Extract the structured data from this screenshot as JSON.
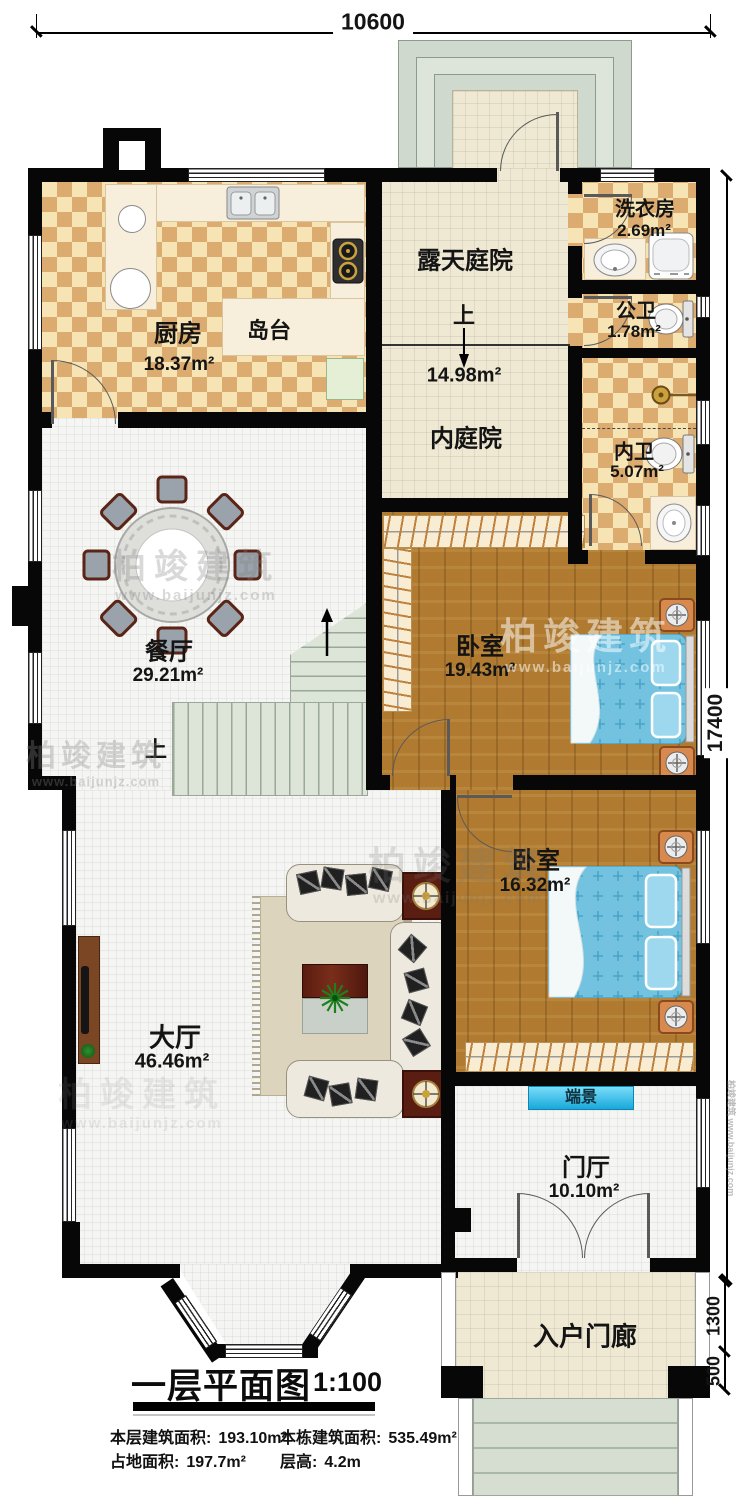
{
  "plan": {
    "title": "一层平面图",
    "scale": "1:100",
    "stats": [
      {
        "label": "本层建筑面积:",
        "value": "193.10m²"
      },
      {
        "label": "本栋建筑面积:",
        "value": "535.49m²"
      },
      {
        "label": "占地面积:",
        "value": "197.7m²"
      },
      {
        "label": "层高:",
        "value": "4.2m"
      }
    ]
  },
  "dimensions": {
    "top_width": "10600",
    "right_height": "17400",
    "porch_depth": "1300",
    "step_depth": "500"
  },
  "rooms": {
    "kitchen": {
      "label": "厨房",
      "area": "18.37m²"
    },
    "island": {
      "label": "岛台"
    },
    "open_courtyard": {
      "label": "露天庭院",
      "up": "上",
      "area": "14.98m²"
    },
    "inner_courtyard": {
      "label": "内庭院"
    },
    "laundry": {
      "label": "洗衣房",
      "area": "2.69m²"
    },
    "public_wc": {
      "label": "公卫",
      "area": "1.78m²"
    },
    "inner_wc": {
      "label": "内卫",
      "area": "5.07m²"
    },
    "dining": {
      "label": "餐厅",
      "area": "29.21m²",
      "up": "上"
    },
    "bedroom1": {
      "label": "卧室",
      "area": "19.43m²"
    },
    "bedroom2": {
      "label": "卧室",
      "area": "16.32m²"
    },
    "hall": {
      "label": "大厅",
      "area": "46.46m²"
    },
    "end_view": {
      "label": "端景"
    },
    "foyer": {
      "label": "门厅",
      "area": "10.10m²"
    },
    "porch": {
      "label": "入户门廊"
    }
  },
  "watermark": {
    "brand": "柏竣建筑",
    "url": "www.baijunjz.com"
  },
  "colors": {
    "wall": "#070707",
    "checker_dark": "#dcab70",
    "checker_light": "#f6e4b4",
    "wood": "#b07b30",
    "bed": "#74c4e2",
    "end_view_bg": "#2fb5e2",
    "stairs": "#dce5d8"
  }
}
